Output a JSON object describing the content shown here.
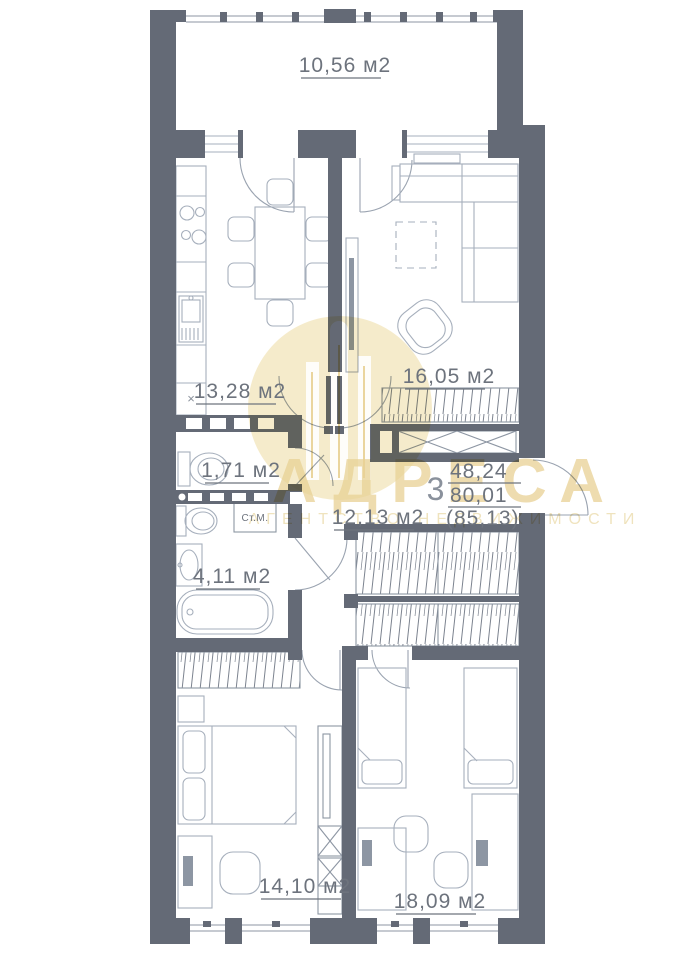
{
  "watermark": {
    "title": "АДРЕСА",
    "subtitle": "АГЕНТСТВО НЕДВИЖИМОСТИ"
  },
  "plan": {
    "rooms": {
      "balcony": {
        "area_label": "10,56 м2"
      },
      "kitchen": {
        "area_label": "13,28 м2"
      },
      "living": {
        "area_label": "16,05 м2"
      },
      "wc": {
        "area_label": "1,71 м2"
      },
      "bathroom": {
        "area_label": "4,11 м2"
      },
      "hallway": {
        "area_label": "12,13 м2"
      },
      "bedroom1": {
        "area_label": "14,10 м2"
      },
      "bedroom2": {
        "area_label": "18,09 м2"
      }
    },
    "summary": {
      "rooms_count": "3",
      "living_area": "48,24",
      "total_area": "80,01",
      "total_area_with_balcony": "(85,13)"
    },
    "fixtures": {
      "washing_machine_label": "Ст.М.",
      "fridge_mark": "×"
    }
  },
  "colors": {
    "wall": "#646a76",
    "furniture_line": "#a6afbc",
    "label_text": "#6d737d",
    "watermark_tan": "#e8d194"
  }
}
